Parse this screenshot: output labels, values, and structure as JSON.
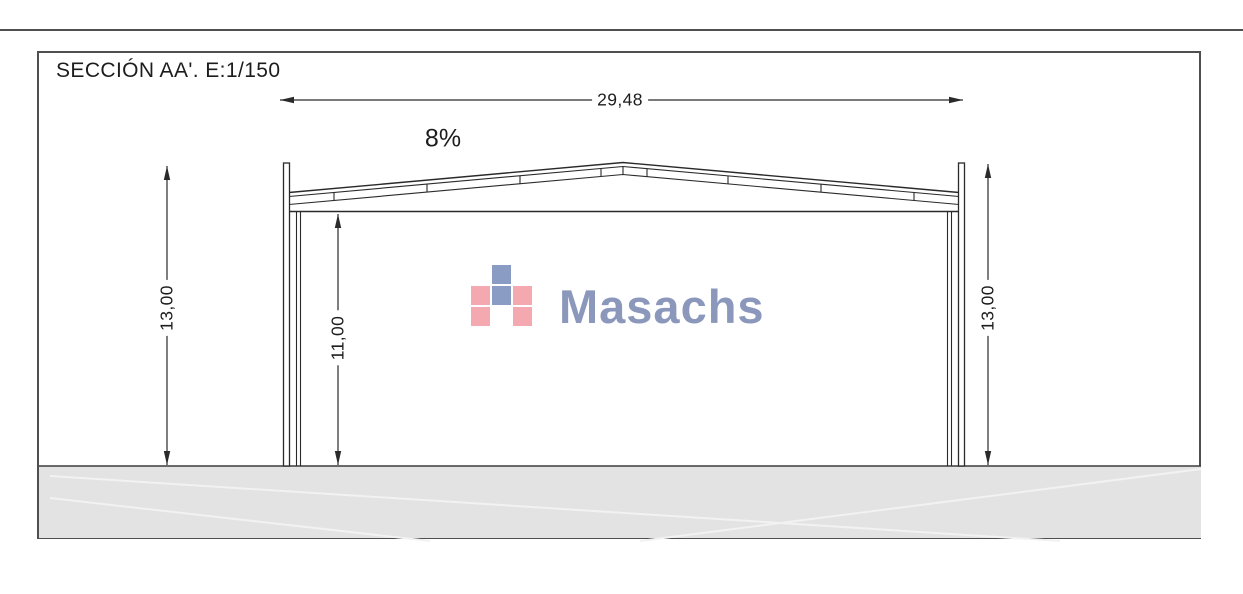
{
  "theme": {
    "line": "#2a2a2a",
    "frame": "#4f4f4f",
    "text": "#1d1d1d",
    "ground_fill": "#e3e3e3",
    "ground_edge": "#3c3c3c",
    "logo_blue": "#8b9cc4",
    "logo_pink": "#f4a9b1",
    "logo_text": "#8b98bc"
  },
  "drawing": {
    "title": "SECCIÓN AA'. E:1/150",
    "dims": {
      "span": "29,48",
      "slope": "8%",
      "height_left": "13,00",
      "clear_height": "11,00",
      "height_right": "13,00"
    },
    "logo": {
      "wordmark": "Masachs",
      "mark_rows": [
        [
          "",
          "blue",
          ""
        ],
        [
          "pink",
          "blue",
          "pink"
        ],
        [
          "pink",
          "",
          "pink"
        ]
      ]
    }
  }
}
